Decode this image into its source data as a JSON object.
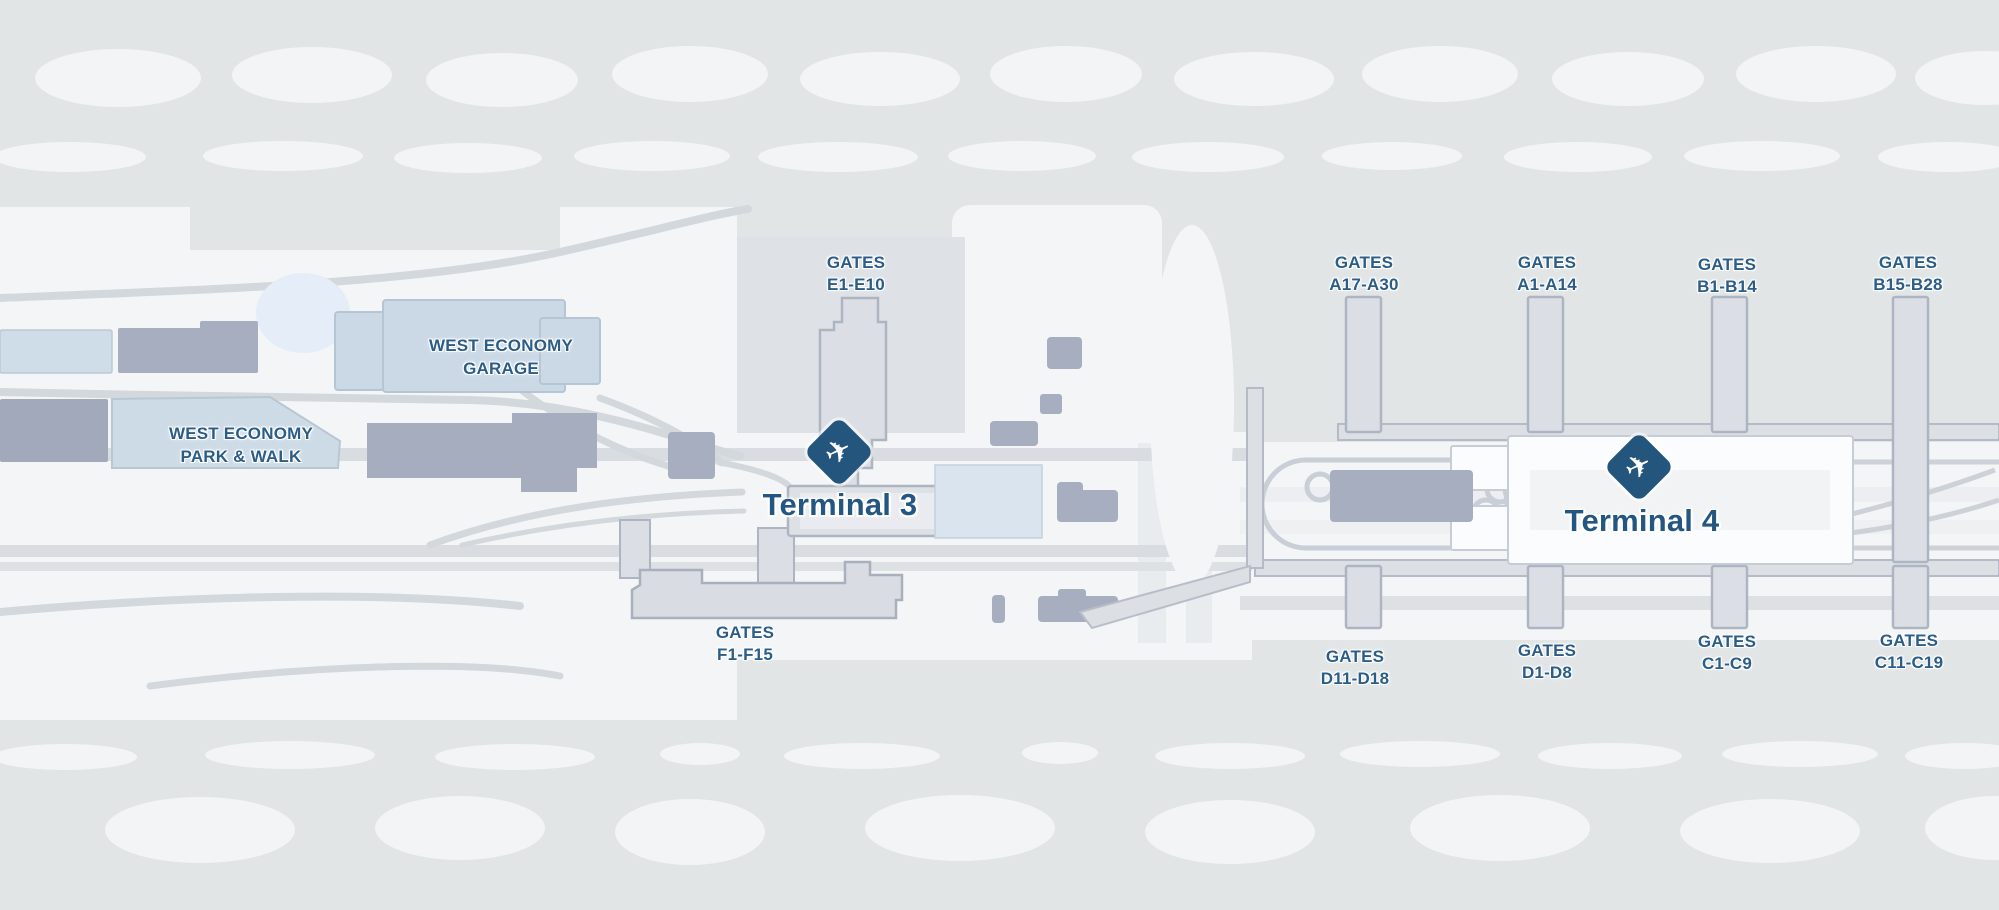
{
  "map_title": "Airport terminal map",
  "terminals": {
    "terminal3": {
      "label": "Terminal 3",
      "icon": "airplane-takeoff-diamond"
    },
    "terminal4": {
      "label": "Terminal 4",
      "icon": "airplane-takeoff-diamond"
    }
  },
  "parking": {
    "west_economy_garage": {
      "line1": "WEST ECONOMY",
      "line2": "GARAGE"
    },
    "west_economy_park_walk": {
      "line1": "WEST ECONOMY",
      "line2": "PARK & WALK"
    }
  },
  "gate_labels": [
    {
      "line1": "GATES",
      "line2": "E1-E10"
    },
    {
      "line1": "GATES",
      "line2": "F1-F15"
    },
    {
      "line1": "GATES",
      "line2": "A17-A30"
    },
    {
      "line1": "GATES",
      "line2": "A1-A14"
    },
    {
      "line1": "GATES",
      "line2": "B1-B14"
    },
    {
      "line1": "GATES",
      "line2": "B15-B28"
    },
    {
      "line1": "GATES",
      "line2": "D11-D18"
    },
    {
      "line1": "GATES",
      "line2": "D1-D8"
    },
    {
      "line1": "GATES",
      "line2": "C1-C9"
    },
    {
      "line1": "GATES",
      "line2": "C11-C19"
    }
  ],
  "icons": {
    "plane_glyph": "✈"
  },
  "colors": {
    "background": "#e1e5e6",
    "land_white": "#f4f5f7",
    "blob_white": "#f2f4f5",
    "road": "#d9dde1",
    "road_stroke": "#d3d8dc",
    "building_gray": "#a7aebf",
    "building_light_blue": "#cddbe7",
    "pond_blue": "#e4edf8",
    "concourse_fill": "#dbdfe5",
    "concourse_stroke": "#aeb5c2",
    "terminal_white": "#fbfcfd",
    "label_blue": "#2b5d87",
    "terminal_label_blue": "#235681",
    "marker_diamond": "#24567d"
  }
}
